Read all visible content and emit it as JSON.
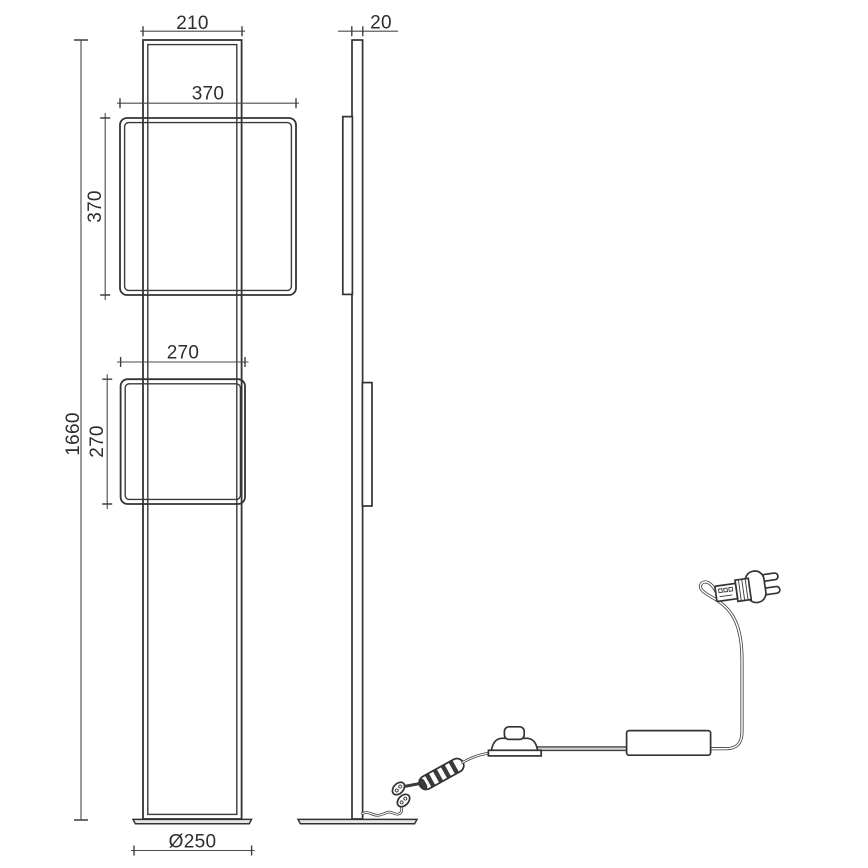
{
  "dimensions": {
    "top_width": "210",
    "frame_large_width": "370",
    "frame_large_height": "370",
    "frame_small_width": "270",
    "frame_small_height": "270",
    "overall_height": "1660",
    "column_depth": "20",
    "base_diameter": "Ø250"
  },
  "colors": {
    "object_line": "#333333",
    "dimension_line": "#4a4a4a",
    "label_text": "#2d2d2d",
    "cord_core": "#cfcfcf",
    "background": "#ffffff"
  }
}
